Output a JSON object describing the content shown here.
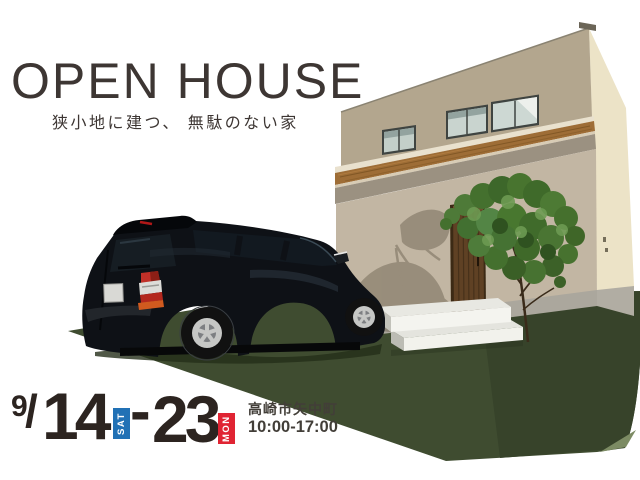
{
  "header": {
    "title": "OPEN HOUSE",
    "subtitle": "狭小地に建つ、 無駄のない家"
  },
  "event": {
    "month": "9",
    "separator": "/",
    "start_day": "14",
    "start_weekday": "SAT",
    "range_dash": "-",
    "end_day": "23",
    "end_weekday": "MON",
    "location": "高崎市矢中町",
    "hours": "10:00-17:00"
  },
  "illustration": {
    "subject": "house-exterior-render-with-black-minivan",
    "elements": [
      "two-story-house",
      "wood-eave",
      "upper-windows",
      "wood-entrance-door",
      "concrete-steps",
      "garden-tree",
      "lawn",
      "black-minivan"
    ]
  },
  "colors": {
    "title_text": "#3d3633",
    "date_text": "#2c2420",
    "info_text": "#423e38",
    "badge_sat_bg": "#2171b5",
    "badge_mon_bg": "#e02433",
    "grass": "#3f4c30",
    "grass_shadow": "#37432a",
    "wall_upper": "#b3a68e",
    "wall_lower": "#c2b6a3",
    "wall_side": "#ece3c7",
    "wood_eave": "#9e6d36",
    "car_body": "#0e1116"
  }
}
